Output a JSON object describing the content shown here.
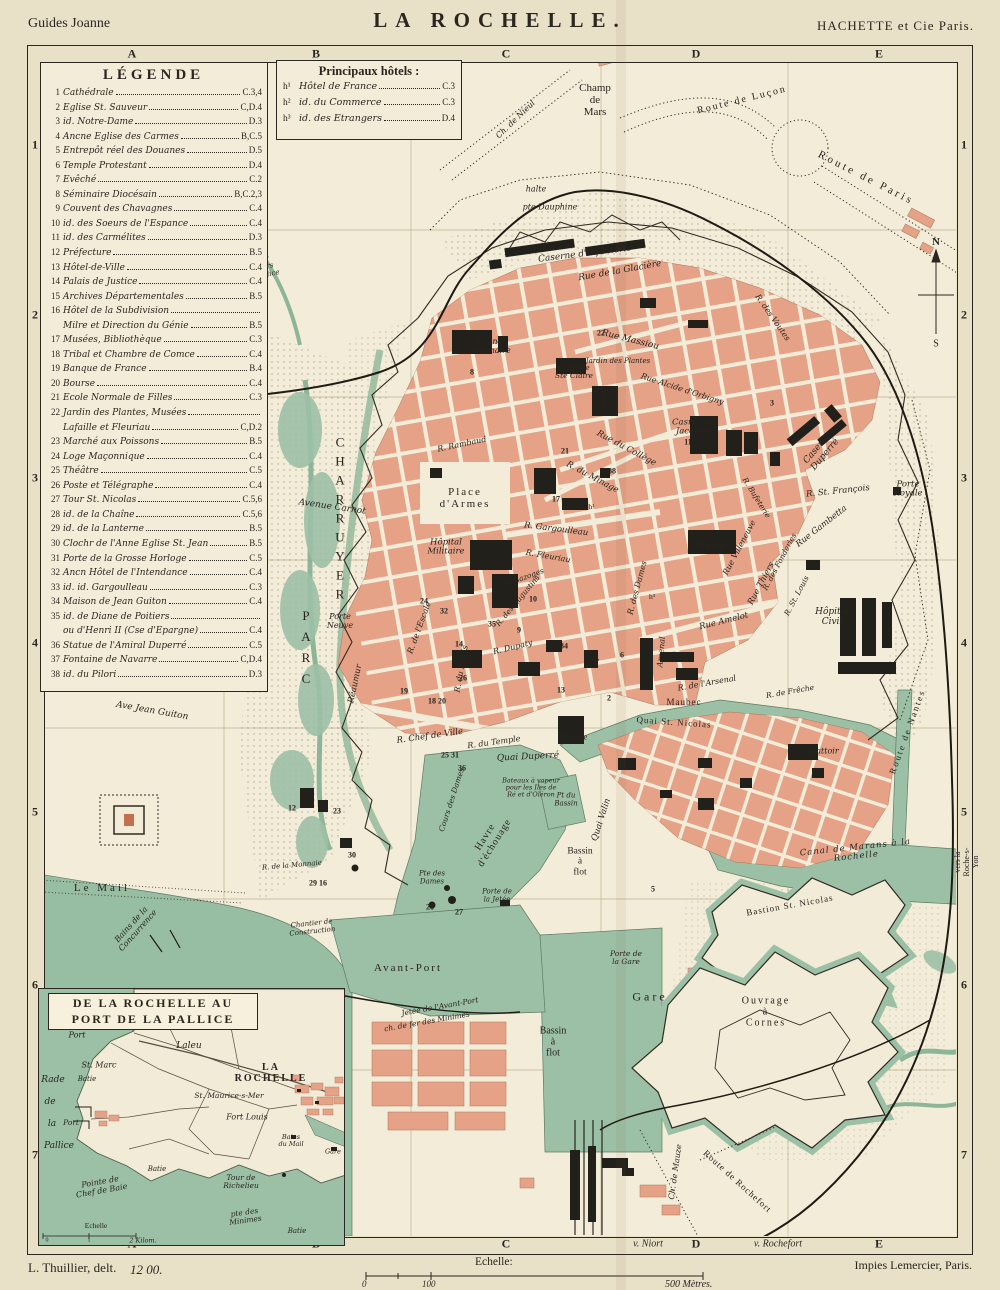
{
  "header": {
    "left": "Guides Joanne",
    "title": "LA ROCHELLE.",
    "right": "HACHETTE et Cie Paris."
  },
  "footer": {
    "author": "L. Thuillier, delt.",
    "plate": "12 00.",
    "scale_label": "Echelle:",
    "scale_zero": "0",
    "scale_hundred": "100",
    "scale_end": "500 Mètres.",
    "printer": "Impies Lemercier, Paris."
  },
  "grid": {
    "cols": [
      "A",
      "B",
      "C",
      "D",
      "E"
    ],
    "col_x": [
      132,
      316,
      506,
      696,
      879
    ],
    "rows": [
      "1",
      "2",
      "3",
      "4",
      "5",
      "6",
      "7"
    ],
    "row_y": [
      145,
      315,
      478,
      643,
      812,
      985,
      1155
    ],
    "bottom_extra": [
      {
        "t": "v. Niort",
        "x": 648
      },
      {
        "t": "v. Rochefort",
        "x": 778
      }
    ]
  },
  "legend": {
    "title": "LÉGENDE",
    "items": [
      {
        "num": "1",
        "name": "Cathédrale",
        "ref": "C.3,4"
      },
      {
        "num": "2",
        "name": "Eglise St. Sauveur",
        "ref": "C,D.4"
      },
      {
        "num": "3",
        "name": "id. Notre-Dame",
        "ref": "D.3"
      },
      {
        "num": "4",
        "name": "Ancne Eglise des Carmes",
        "ref": "B,C.5"
      },
      {
        "num": "5",
        "name": "Entrepôt réel des Douanes",
        "ref": "D.5"
      },
      {
        "num": "6",
        "name": "Temple Protestant",
        "ref": "D.4"
      },
      {
        "num": "7",
        "name": "Evêché",
        "ref": "C.2"
      },
      {
        "num": "8",
        "name": "Séminaire Diocésain",
        "ref": "B,C.2,3"
      },
      {
        "num": "9",
        "name": "Couvent des Chavagnes",
        "ref": "C.4"
      },
      {
        "num": "10",
        "name": "id. des Soeurs de l'Espance",
        "ref": "C.4"
      },
      {
        "num": "11",
        "name": "id. des Carmélites",
        "ref": "D.3"
      },
      {
        "num": "12",
        "name": "Préfecture",
        "ref": "B.5"
      },
      {
        "num": "13",
        "name": "Hôtel-de-Ville",
        "ref": "C.4"
      },
      {
        "num": "14",
        "name": "Palais de Justice",
        "ref": "C.4"
      },
      {
        "num": "15",
        "name": "Archives Départementales",
        "ref": "B.5"
      },
      {
        "num": "16",
        "name": "Hôtel de la Subdivision",
        "name2": "Milre et Direction du Génie",
        "ref": "B.5"
      },
      {
        "num": "17",
        "name": "Musées, Bibliothèque",
        "ref": "C.3"
      },
      {
        "num": "18",
        "name": "Tribal et Chambre de Comce",
        "ref": "C.4"
      },
      {
        "num": "19",
        "name": "Banque de France",
        "ref": "B.4"
      },
      {
        "num": "20",
        "name": "Bourse",
        "ref": "C.4"
      },
      {
        "num": "21",
        "name": "Ecole Normale de Filles",
        "ref": "C.3"
      },
      {
        "num": "22",
        "name": "Jardin des Plantes, Musées",
        "name2": "Lafaille et Fleuriau",
        "ref": "C,D.2"
      },
      {
        "num": "23",
        "name": "Marché aux Poissons",
        "ref": "B.5"
      },
      {
        "num": "24",
        "name": "Loge Maçonnique",
        "ref": "C.4"
      },
      {
        "num": "25",
        "name": "Théâtre",
        "ref": "C.5"
      },
      {
        "num": "26",
        "name": "Poste et Télégraphe",
        "ref": "C.4"
      },
      {
        "num": "27",
        "name": "Tour St. Nicolas",
        "ref": "C.5,6"
      },
      {
        "num": "28",
        "name": "id. de la Chaîne",
        "ref": "C.5,6"
      },
      {
        "num": "29",
        "name": "id. de la Lanterne",
        "ref": "B.5"
      },
      {
        "num": "30",
        "name": "Clochr de l'Anne Eglise St. Jean",
        "ref": "B.5"
      },
      {
        "num": "31",
        "name": "Porte de la Grosse Horloge",
        "ref": "C.5"
      },
      {
        "num": "32",
        "name": "Ancn Hôtel de l'Intendance",
        "ref": "C.4"
      },
      {
        "num": "33",
        "name": "id. id. Gargoulleau",
        "ref": "C.3"
      },
      {
        "num": "34",
        "name": "Maison de Jean Guiton",
        "ref": "C.4"
      },
      {
        "num": "35",
        "name": "id. de Diane de Poitiers",
        "name2": "ou d'Henri II (Cse d'Epargne)",
        "ref": "C.4"
      },
      {
        "num": "36",
        "name": "Statue de l'Amiral Duperré",
        "ref": "C.5"
      },
      {
        "num": "37",
        "name": "Fontaine de Navarre",
        "ref": "C,D.4"
      },
      {
        "num": "38",
        "name": "id. du Pilori",
        "ref": "D.3"
      }
    ]
  },
  "hotels": {
    "title": "Principaux hôtels :",
    "items": [
      {
        "sup": "h¹",
        "name": "Hôtel de France",
        "ref": "C.3"
      },
      {
        "sup": "h²",
        "name": "id. du Commerce",
        "ref": "C.3"
      },
      {
        "sup": "h³",
        "name": "id. des Etrangers",
        "ref": "D.4"
      }
    ]
  },
  "inset": {
    "title1": "DE LA ROCHELLE AU",
    "title2": "PORT DE LA PALLICE",
    "labels": [
      {
        "t": "Port",
        "x": 38,
        "y": 47,
        "s": 8,
        "i": 1
      },
      {
        "t": "La Repentie",
        "x": 94,
        "y": 38,
        "s": 8.5,
        "i": 1
      },
      {
        "t": "Laleu",
        "x": 150,
        "y": 58,
        "s": 9,
        "i": 1
      },
      {
        "t": "St. Marc",
        "x": 60,
        "y": 77,
        "s": 8,
        "i": 1
      },
      {
        "t": "Batie",
        "x": 48,
        "y": 91,
        "s": 7,
        "i": 1
      },
      {
        "t": "Rade",
        "x": 14,
        "y": 92,
        "s": 9,
        "i": 1
      },
      {
        "t": "de",
        "x": 11,
        "y": 114,
        "s": 9,
        "i": 1
      },
      {
        "t": "la",
        "x": 13,
        "y": 136,
        "s": 9,
        "i": 1
      },
      {
        "t": "Pallice",
        "x": 20,
        "y": 158,
        "s": 9,
        "i": 1
      },
      {
        "t": "Port",
        "x": 32,
        "y": 134,
        "s": 7.5,
        "i": 1
      },
      {
        "t": "LA ROCHELLE",
        "x": 232,
        "y": 84,
        "s": 10,
        "sp": 2,
        "b": 1
      },
      {
        "t": "St. Maurice-s-Mer",
        "x": 190,
        "y": 107,
        "s": 7.5,
        "i": 1
      },
      {
        "t": "Fort Louis",
        "x": 208,
        "y": 129,
        "s": 8,
        "i": 1
      },
      {
        "t": "Bains\ndu Mail",
        "x": 252,
        "y": 152,
        "s": 6.5,
        "i": 1
      },
      {
        "t": "Gare",
        "x": 294,
        "y": 163,
        "s": 6.5,
        "i": 1
      },
      {
        "t": "Batie",
        "x": 118,
        "y": 181,
        "s": 7,
        "i": 1
      },
      {
        "t": "Pointe de\nChef de Baie",
        "x": 62,
        "y": 198,
        "r": -10,
        "s": 8,
        "i": 1
      },
      {
        "t": "Tour de\nRichelieu",
        "x": 202,
        "y": 193,
        "s": 7.5,
        "i": 1
      },
      {
        "t": "Echelle",
        "x": 57,
        "y": 237,
        "s": 7.5
      },
      {
        "t": "0",
        "x": 8,
        "y": 252,
        "s": 6
      },
      {
        "t": "1",
        "x": 50,
        "y": 252,
        "s": 6
      },
      {
        "t": "2 Kilom.",
        "x": 104,
        "y": 252,
        "s": 6.5,
        "i": 1
      },
      {
        "t": "pte des\nMinimes",
        "x": 206,
        "y": 228,
        "r": -8,
        "s": 7.5,
        "i": 1
      },
      {
        "t": "Batie",
        "x": 258,
        "y": 243,
        "s": 7,
        "i": 1
      }
    ]
  },
  "map_labels": [
    {
      "t": "Champ\nde\nMars",
      "x": 595,
      "y": 100,
      "s": 11
    },
    {
      "t": "Route de Luçon",
      "x": 742,
      "y": 100,
      "r": -14,
      "s": 10,
      "sp": 2
    },
    {
      "t": "Route de Paris",
      "x": 866,
      "y": 178,
      "r": 27,
      "s": 11,
      "sp": 3
    },
    {
      "t": "Ch. de Nieul",
      "x": 516,
      "y": 120,
      "r": -44,
      "s": 8,
      "i": 1
    },
    {
      "t": "halte",
      "x": 536,
      "y": 190,
      "s": 8,
      "i": 1
    },
    {
      "t": "pte Dauphine",
      "x": 550,
      "y": 208,
      "s": 8,
      "i": 1
    },
    {
      "t": "Caserne d'Infanterie",
      "x": 585,
      "y": 255,
      "r": -7,
      "s": 9,
      "i": 1
    },
    {
      "t": "Rue de la Glacière",
      "x": 620,
      "y": 272,
      "r": -10,
      "s": 9,
      "i": 1
    },
    {
      "t": "N",
      "x": 936,
      "y": 242,
      "s": 11,
      "b": 1
    },
    {
      "t": "S",
      "x": 936,
      "y": 344,
      "s": 10
    },
    {
      "t": "Grand\nSéminaire",
      "x": 490,
      "y": 347,
      "s": 8,
      "i": 1
    },
    {
      "t": "Caserne\nSte Claire",
      "x": 574,
      "y": 372,
      "s": 7.5,
      "i": 1
    },
    {
      "t": "Lycée",
      "x": 603,
      "y": 400,
      "r": -75,
      "s": 7.5,
      "i": 1
    },
    {
      "t": "Rue Massiou",
      "x": 630,
      "y": 341,
      "r": 14,
      "s": 9,
      "i": 1
    },
    {
      "t": "Jardin des Plantes",
      "x": 618,
      "y": 362,
      "s": 7,
      "i": 1
    },
    {
      "t": "Rue Alcide d'Orbigny",
      "x": 682,
      "y": 390,
      "r": 18,
      "s": 8,
      "i": 1
    },
    {
      "t": "Casne des\nJacobins",
      "x": 694,
      "y": 428,
      "s": 8.5,
      "i": 1
    },
    {
      "t": "R. des Voutes",
      "x": 772,
      "y": 318,
      "r": 55,
      "s": 8,
      "i": 1
    },
    {
      "t": "Caserne\nDuperré",
      "x": 822,
      "y": 452,
      "r": -50,
      "s": 9,
      "i": 1
    },
    {
      "t": "R. St. François",
      "x": 838,
      "y": 492,
      "r": -6,
      "s": 8.5,
      "i": 1
    },
    {
      "t": "Porte\nRoyale",
      "x": 908,
      "y": 490,
      "s": 8.5,
      "i": 1
    },
    {
      "t": "Rue du Collège",
      "x": 626,
      "y": 449,
      "r": 28,
      "s": 8.5,
      "i": 1
    },
    {
      "t": "R. du Minage",
      "x": 592,
      "y": 478,
      "r": 28,
      "s": 8.5,
      "i": 1
    },
    {
      "t": "Place\nd'Armes",
      "x": 465,
      "y": 498,
      "s": 11,
      "sp": 2
    },
    {
      "t": "R. Gargoulleau",
      "x": 556,
      "y": 530,
      "r": 7,
      "s": 8.5,
      "i": 1
    },
    {
      "t": "R. Fleuriau",
      "x": 548,
      "y": 557,
      "r": 10,
      "s": 8,
      "i": 1
    },
    {
      "t": "Hôpital\nMilitaire",
      "x": 446,
      "y": 548,
      "s": 8.5,
      "i": 1
    },
    {
      "t": "R. Rambaud",
      "x": 462,
      "y": 445,
      "r": -12,
      "s": 8,
      "i": 1
    },
    {
      "t": "Marché",
      "x": 710,
      "y": 546,
      "s": 9.5
    },
    {
      "t": "Rue Thiers",
      "x": 762,
      "y": 584,
      "r": -62,
      "s": 8.5,
      "i": 1
    },
    {
      "t": "Rue Villeneuve",
      "x": 740,
      "y": 548,
      "r": -62,
      "s": 8,
      "i": 1
    },
    {
      "t": "R. des Fonderies",
      "x": 780,
      "y": 562,
      "r": -62,
      "s": 7.5,
      "i": 1
    },
    {
      "t": "R. St. Louis",
      "x": 797,
      "y": 596,
      "r": -62,
      "s": 7.5,
      "i": 1
    },
    {
      "t": "Rue Gambetta",
      "x": 822,
      "y": 527,
      "r": -38,
      "s": 8.5,
      "i": 1
    },
    {
      "t": "R. Bufeterie",
      "x": 756,
      "y": 498,
      "r": 58,
      "s": 7.5,
      "i": 1
    },
    {
      "t": "Rue Amelot",
      "x": 724,
      "y": 622,
      "r": -14,
      "s": 8.5,
      "i": 1
    },
    {
      "t": "R. des Dames",
      "x": 638,
      "y": 588,
      "r": -75,
      "s": 8,
      "i": 1
    },
    {
      "t": "Arsenal",
      "x": 662,
      "y": 652,
      "r": -85,
      "s": 8,
      "i": 1
    },
    {
      "t": "R. de l'Arsenal",
      "x": 707,
      "y": 684,
      "r": -10,
      "s": 8,
      "i": 1
    },
    {
      "t": "Hôpital\nCivil",
      "x": 832,
      "y": 618,
      "s": 9,
      "i": 1
    },
    {
      "t": "R. de Frêche",
      "x": 790,
      "y": 692,
      "r": -10,
      "s": 7.5,
      "i": 1
    },
    {
      "t": "R. de l'Escale",
      "x": 420,
      "y": 628,
      "r": -70,
      "s": 8,
      "i": 1
    },
    {
      "t": "Réaumur",
      "x": 356,
      "y": 684,
      "r": -78,
      "s": 8.5,
      "i": 1
    },
    {
      "t": "R. Chef de Ville",
      "x": 430,
      "y": 737,
      "r": -8,
      "s": 8.5,
      "i": 1
    },
    {
      "t": "R. du Temple",
      "x": 494,
      "y": 743,
      "r": -8,
      "s": 8,
      "i": 1
    },
    {
      "t": "R. Dupaty",
      "x": 513,
      "y": 648,
      "r": -14,
      "s": 8,
      "i": 1
    },
    {
      "t": "R. des Augustins",
      "x": 518,
      "y": 601,
      "r": -50,
      "s": 7.5,
      "i": 1
    },
    {
      "t": "R. Bazoges",
      "x": 524,
      "y": 578,
      "r": -20,
      "s": 7.5,
      "i": 1
    },
    {
      "t": "R. du Palais",
      "x": 462,
      "y": 669,
      "r": -80,
      "s": 8,
      "i": 1
    },
    {
      "t": "Quai Duperré",
      "x": 528,
      "y": 758,
      "r": -3,
      "s": 9,
      "i": 1
    },
    {
      "t": "Bateaux à vapeur\npour les Iles de\nRé et d'Oléron",
      "x": 531,
      "y": 788,
      "s": 6.5,
      "i": 1
    },
    {
      "t": "Douane",
      "x": 574,
      "y": 737,
      "s": 8.5
    },
    {
      "t": "Maubec",
      "x": 684,
      "y": 703,
      "s": 9,
      "sp": 1
    },
    {
      "t": "Quai St. Nicolas",
      "x": 674,
      "y": 723,
      "r": 4,
      "s": 9,
      "sp": 1
    },
    {
      "t": "Quai Valin",
      "x": 602,
      "y": 820,
      "r": -72,
      "s": 8.5,
      "i": 1
    },
    {
      "t": "Havre\nd'échouage",
      "x": 490,
      "y": 840,
      "r": -58,
      "s": 10,
      "sp": 1
    },
    {
      "t": "Cours des Dames",
      "x": 452,
      "y": 800,
      "r": -72,
      "s": 7.5,
      "i": 1
    },
    {
      "t": "Pt du\nBassin",
      "x": 566,
      "y": 800,
      "s": 7,
      "i": 1
    },
    {
      "t": "Bassin\nà\nflot",
      "x": 580,
      "y": 862,
      "s": 9.5
    },
    {
      "t": "Pte des\nDames",
      "x": 432,
      "y": 878,
      "s": 7,
      "i": 1
    },
    {
      "t": "Porte de\nla Jetée",
      "x": 497,
      "y": 896,
      "s": 7,
      "i": 1
    },
    {
      "t": "Chantier de\nConstruction",
      "x": 312,
      "y": 928,
      "r": -6,
      "s": 7,
      "i": 1
    },
    {
      "t": "Le Mail",
      "x": 102,
      "y": 888,
      "s": 11,
      "sp": 3
    },
    {
      "t": "Bains de la\nConcurrence",
      "x": 135,
      "y": 928,
      "r": -48,
      "s": 8,
      "i": 1
    },
    {
      "t": "Ave Jean Guiton",
      "x": 152,
      "y": 712,
      "r": 10,
      "s": 9,
      "i": 1
    },
    {
      "t": "PARC",
      "x": 306,
      "y": 650,
      "s": 13,
      "v": 1,
      "sp": 6
    },
    {
      "t": "CHARRUYER",
      "x": 340,
      "y": 520,
      "s": 13,
      "v": 1,
      "sp": 4
    },
    {
      "t": "Avenue Carnot",
      "x": 332,
      "y": 508,
      "r": 8,
      "s": 9,
      "i": 1
    },
    {
      "t": "Porte\nNeuve",
      "x": 340,
      "y": 622,
      "s": 8,
      "i": 1
    },
    {
      "t": "← vers\nla Pallice",
      "x": 263,
      "y": 272,
      "r": -12,
      "s": 7,
      "i": 1
    },
    {
      "t": "R. de la Monnaie",
      "x": 292,
      "y": 866,
      "r": -5,
      "s": 7,
      "i": 1
    },
    {
      "t": "Bastion St. Nicolas",
      "x": 790,
      "y": 906,
      "r": -10,
      "s": 9,
      "sp": 1
    },
    {
      "t": "Abattoir",
      "x": 822,
      "y": 752,
      "s": 8,
      "i": 1
    },
    {
      "t": "Canal de Marans à la Rochelle",
      "x": 856,
      "y": 853,
      "r": -6,
      "s": 8.5,
      "i": 1,
      "sp": 1
    },
    {
      "t": "Route de Nantes",
      "x": 908,
      "y": 732,
      "r": -70,
      "s": 9,
      "sp": 2
    },
    {
      "t": "vers la Roche-s-Yon",
      "x": 967,
      "y": 862,
      "r": -90,
      "s": 8
    },
    {
      "t": "Ouvrage\nà\nCornes",
      "x": 766,
      "y": 1012,
      "s": 10,
      "sp": 2
    },
    {
      "t": "Gare",
      "x": 650,
      "y": 997,
      "s": 12,
      "sp": 3
    },
    {
      "t": "Porte de\nla Gare",
      "x": 626,
      "y": 958,
      "s": 7.5,
      "i": 1
    },
    {
      "t": "Avant-Port",
      "x": 408,
      "y": 968,
      "s": 11,
      "sp": 2
    },
    {
      "t": "Bassin\nà\nflot",
      "x": 553,
      "y": 1042,
      "s": 10
    },
    {
      "t": "Jetée de l'Avant-Port",
      "x": 440,
      "y": 1007,
      "r": -10,
      "s": 7.5,
      "i": 1
    },
    {
      "t": "ch. de fer des Minimes",
      "x": 427,
      "y": 1022,
      "r": -10,
      "s": 7.5,
      "i": 1
    },
    {
      "t": "Route de Rochefort",
      "x": 737,
      "y": 1182,
      "r": 42,
      "s": 9,
      "sp": 1
    },
    {
      "t": "Ch. de Mauze",
      "x": 676,
      "y": 1172,
      "r": -82,
      "s": 8,
      "i": 1
    },
    {
      "t": "33è h¹",
      "x": 585,
      "y": 507,
      "s": 7.5
    },
    {
      "t": "h³",
      "x": 652,
      "y": 597,
      "s": 7.5
    },
    {
      "t": "8",
      "x": 472,
      "y": 373,
      "num": 1
    },
    {
      "t": "22",
      "x": 601,
      "y": 334,
      "num": 1
    },
    {
      "t": "3",
      "x": 772,
      "y": 404,
      "num": 1
    },
    {
      "t": "11",
      "x": 688,
      "y": 443,
      "num": 1
    },
    {
      "t": "21",
      "x": 565,
      "y": 452,
      "num": 1
    },
    {
      "t": "38",
      "x": 612,
      "y": 472,
      "num": 1
    },
    {
      "t": "17",
      "x": 556,
      "y": 500,
      "num": 1
    },
    {
      "t": "10",
      "x": 533,
      "y": 600,
      "num": 1
    },
    {
      "t": "24",
      "x": 424,
      "y": 602,
      "num": 1
    },
    {
      "t": "32",
      "x": 444,
      "y": 612,
      "num": 1
    },
    {
      "t": "35",
      "x": 492,
      "y": 625,
      "num": 1
    },
    {
      "t": "9",
      "x": 519,
      "y": 631,
      "num": 1
    },
    {
      "t": "14",
      "x": 459,
      "y": 645,
      "num": 1
    },
    {
      "t": "34",
      "x": 564,
      "y": 647,
      "num": 1
    },
    {
      "t": "6",
      "x": 622,
      "y": 656,
      "num": 1
    },
    {
      "t": "37",
      "x": 595,
      "y": 663,
      "num": 1
    },
    {
      "t": "26",
      "x": 463,
      "y": 679,
      "num": 1
    },
    {
      "t": "19",
      "x": 404,
      "y": 692,
      "num": 1
    },
    {
      "t": "18 20",
      "x": 437,
      "y": 702,
      "num": 1
    },
    {
      "t": "25 31",
      "x": 450,
      "y": 756,
      "num": 1
    },
    {
      "t": "36",
      "x": 462,
      "y": 769,
      "num": 1
    },
    {
      "t": "2",
      "x": 609,
      "y": 699,
      "num": 1
    },
    {
      "t": "13",
      "x": 561,
      "y": 691,
      "num": 1
    },
    {
      "t": "12",
      "x": 292,
      "y": 809,
      "num": 1
    },
    {
      "t": "23",
      "x": 337,
      "y": 812,
      "num": 1
    },
    {
      "t": "30",
      "x": 352,
      "y": 856,
      "num": 1
    },
    {
      "t": "29 16",
      "x": 318,
      "y": 884,
      "num": 1
    },
    {
      "t": "27",
      "x": 459,
      "y": 913,
      "num": 1
    },
    {
      "t": "28",
      "x": 430,
      "y": 908,
      "num": 1
    },
    {
      "t": "5",
      "x": 653,
      "y": 890,
      "num": 1
    }
  ],
  "colors": {
    "paper": "#e9e0c8",
    "map_bg": "#f3ecd8",
    "water": "#9cc0a6",
    "salmon": "#e5a286",
    "ink": "#2b2620"
  }
}
